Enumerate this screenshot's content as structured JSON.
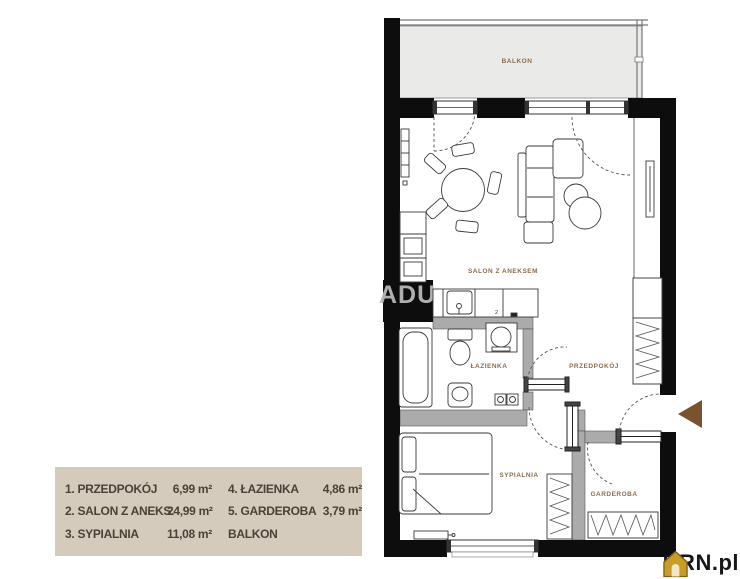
{
  "watermark": {
    "text": "ADU"
  },
  "logo": {
    "text": "KRN.pl"
  },
  "plan": {
    "rooms": [
      {
        "id": "balkon",
        "label": "BALKON"
      },
      {
        "id": "salon",
        "label": "SALON Z ANEKSEM"
      },
      {
        "id": "lazienka",
        "label": "ŁAZIENKA"
      },
      {
        "id": "przedpokoj",
        "label": "PRZEDPOKÓJ"
      },
      {
        "id": "sypialnia",
        "label": "SYPIALNIA"
      },
      {
        "id": "garderoba",
        "label": "GARDEROBA"
      }
    ],
    "counter_mark": "2"
  },
  "legend": {
    "items": [
      {
        "label": "1. PRZEDPOKÓJ",
        "area": "6,99 m²"
      },
      {
        "label": "2. SALON Z ANEKS.",
        "area": "24,99 m²"
      },
      {
        "label": "3. SYPIALNIA",
        "area": "11,08 m²"
      },
      {
        "label": "4. ŁAZIENKA",
        "area": "4,86 m²"
      },
      {
        "label": "5. GARDEROBA",
        "area": "3,79 m²"
      },
      {
        "label": "BALKON",
        "area": ""
      }
    ]
  },
  "colors": {
    "legend_bg": "#d5cbbc",
    "room_label": "#8a6e4e",
    "entrance_arrow": "#7a5230",
    "wall": "#0d0d0d",
    "partition_wall": "#ababab",
    "balcony_fill": "#eaeae8",
    "logo_house": "#c99b28"
  }
}
